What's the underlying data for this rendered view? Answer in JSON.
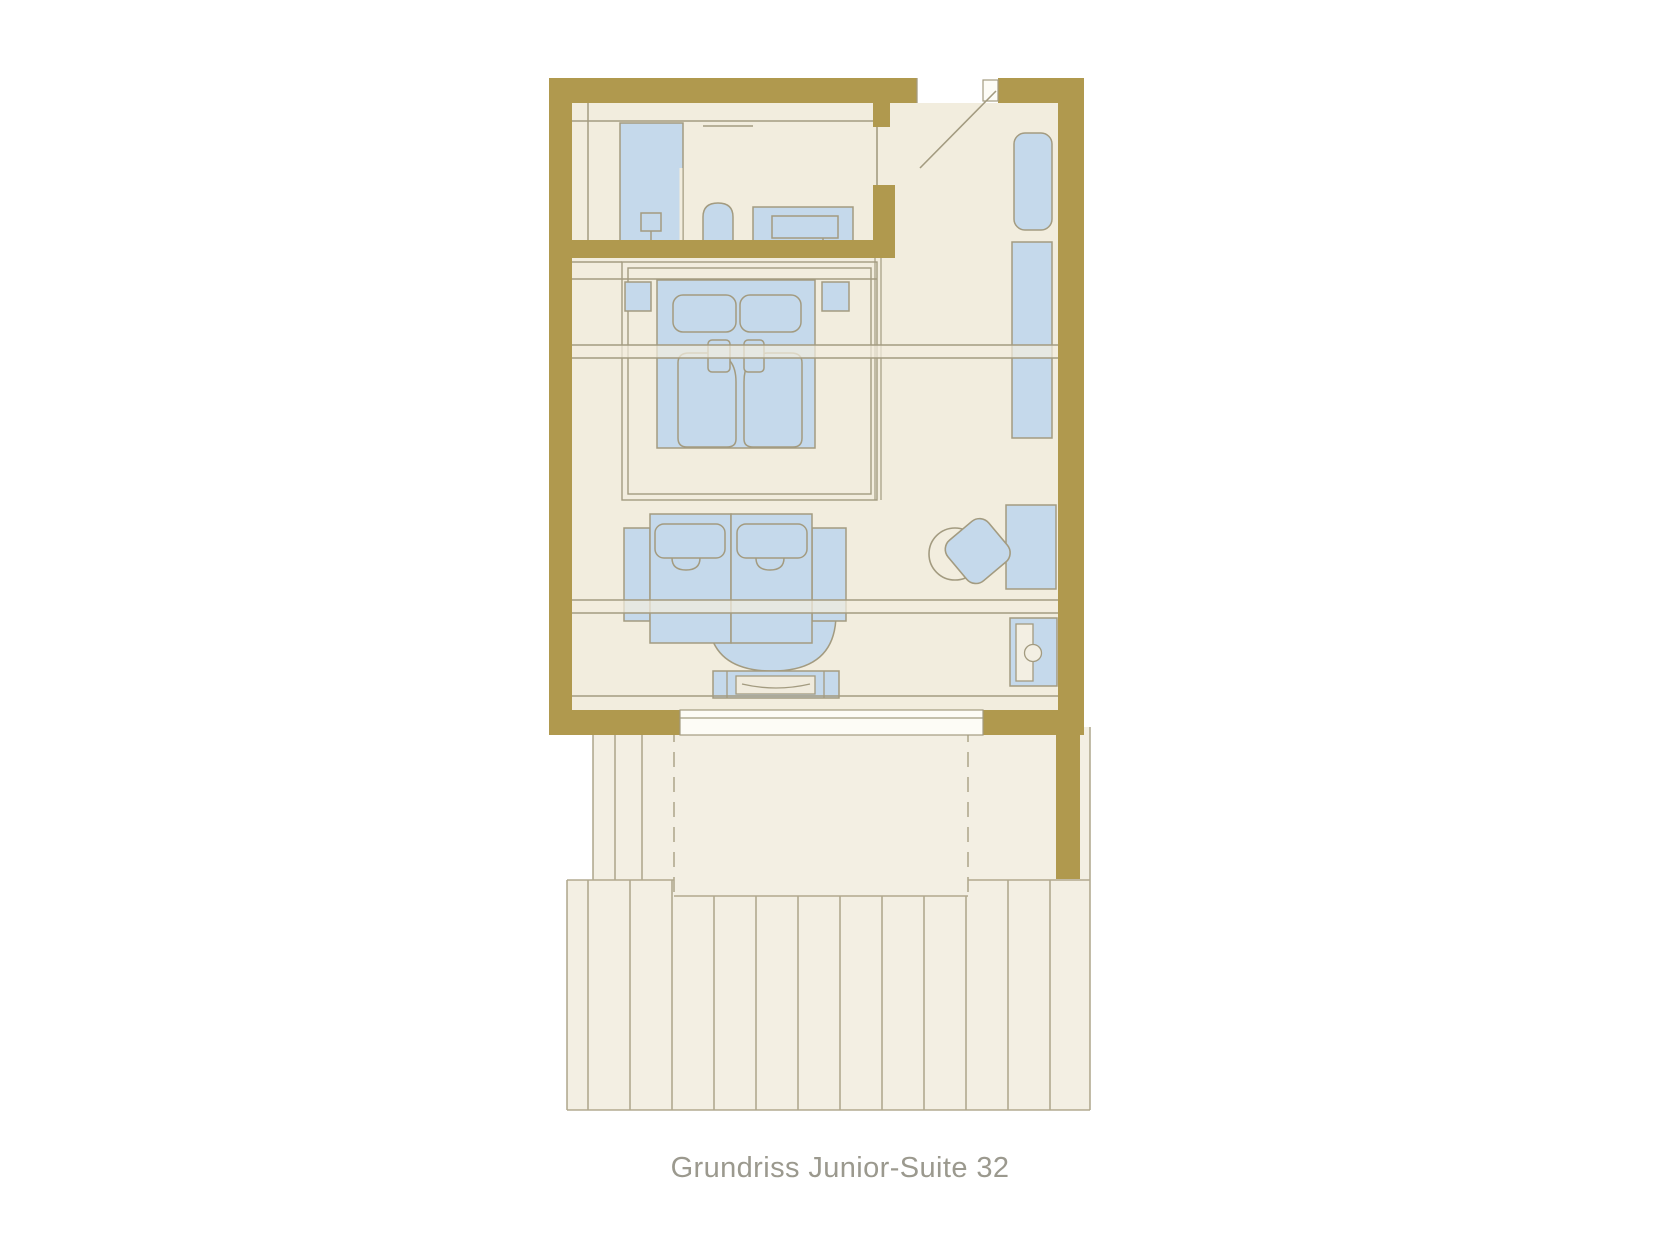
{
  "caption": {
    "text": "Grundriss Junior-Suite 32"
  },
  "palette": {
    "wall_gold": "#b0994e",
    "floor_cream": "#f2edde",
    "terrace_cream": "#f3efe3",
    "furniture_blue": "#c5d9eb",
    "outline_olive": "#a39b80",
    "window_white": "#fdfcf6",
    "caption_gray": "#9b998e",
    "page_background": "#ffffff"
  },
  "plan": {
    "type": "hotel-suite-floor-plan",
    "rooms": [
      "bathroom",
      "sleeping-area",
      "living-area",
      "entrance-hall",
      "terrace",
      "wood-deck"
    ],
    "furniture": [
      "shower",
      "shower-fixture",
      "toilet",
      "vanity-sink",
      "mirror",
      "double-bed",
      "pillows",
      "duvet",
      "nightstand-left",
      "nightstand-right",
      "bed-platform",
      "luggage-bench",
      "wardrobe",
      "desk",
      "desk-chair",
      "sofa",
      "round-table",
      "tv-sideboard",
      "minibar",
      "entrance-door",
      "window-front",
      "terrace-railing",
      "deck-planks"
    ]
  }
}
